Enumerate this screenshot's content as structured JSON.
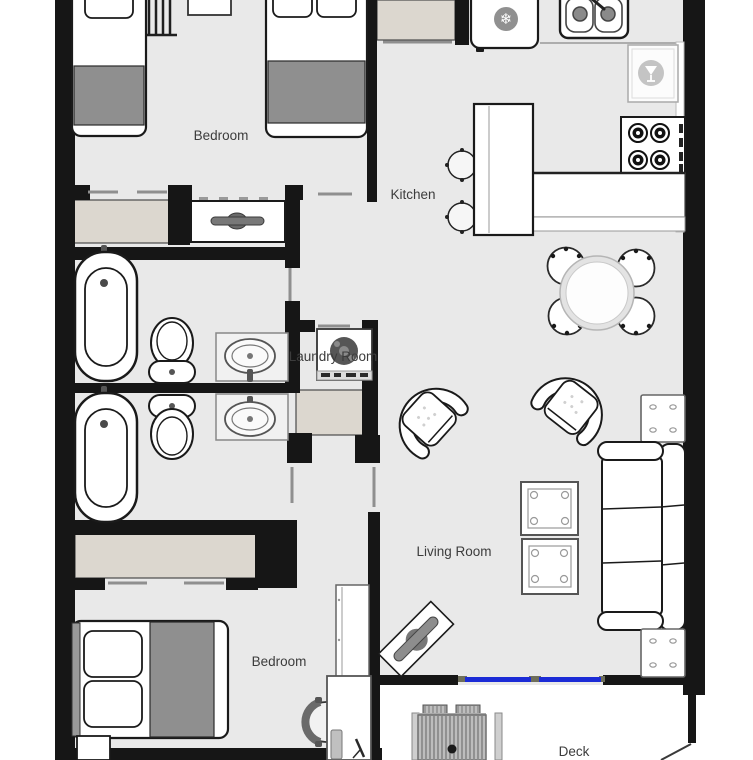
{
  "floorplan": {
    "rooms": {
      "bedroom_top": "Bedroom",
      "kitchen": "Kitchen",
      "laundry": "Laundry Room",
      "living": "Living Room",
      "bedroom_bottom": "Bedroom",
      "deck": "Deck"
    },
    "colors": {
      "wall": "#161616",
      "floor": "#e9e9e9",
      "closet_fill": "#dcd7cf",
      "blanket_gray": "#8f8f8f",
      "window_glass_blue": "#1b2bd6",
      "door_line_gray": "#8f8f8f",
      "label_text": "#3c3c3c"
    },
    "icons": {
      "fridge_snowflake": "❄"
    }
  }
}
